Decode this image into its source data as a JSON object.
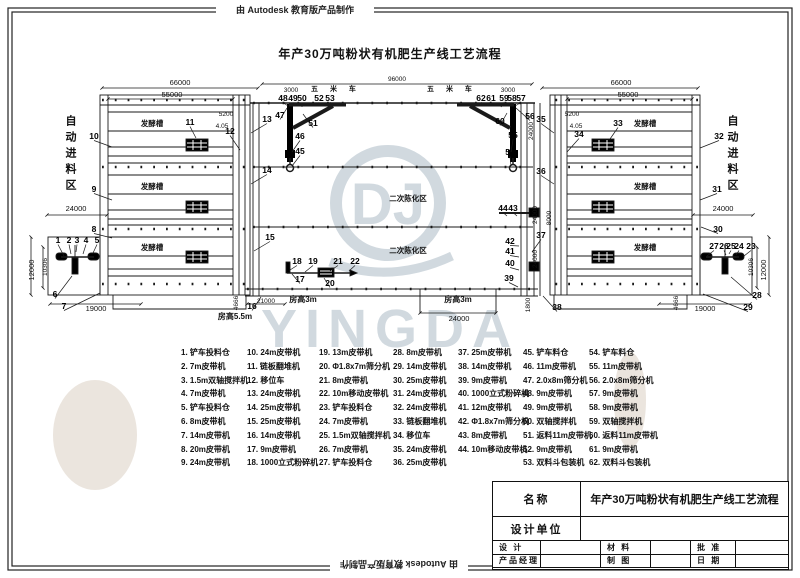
{
  "banner": {
    "top": "由 Autodesk 教育版产品制作",
    "bottom": "由 Autodesk 教育版产品制作"
  },
  "title": "年产30万吨粉状有机肥生产线工艺流程",
  "watermark": {
    "brand": "YINGDA",
    "monogram": "DJ"
  },
  "drawing": {
    "zone_left": "自动进料区",
    "zone_right": "自动进料区",
    "dims": [
      {
        "t": "66000",
        "x": 180,
        "y": 85
      },
      {
        "t": "55000",
        "x": 172,
        "y": 97
      },
      {
        "t": "96000",
        "x": 397,
        "y": 81,
        "c": "s"
      },
      {
        "t": "66000",
        "x": 621,
        "y": 85
      },
      {
        "t": "55000",
        "x": 628,
        "y": 97
      },
      {
        "t": "3000",
        "x": 291,
        "y": 92,
        "c": "s"
      },
      {
        "t": "3000",
        "x": 508,
        "y": 92,
        "c": "s"
      },
      {
        "t": "五 米 车",
        "x": 336,
        "y": 91,
        "c": "zs"
      },
      {
        "t": "五 米 车",
        "x": 452,
        "y": 91,
        "c": "zs"
      },
      {
        "t": "5200",
        "x": 226,
        "y": 116,
        "c": "s"
      },
      {
        "t": "4.05",
        "x": 222,
        "y": 128,
        "c": "s"
      },
      {
        "t": "5200",
        "x": 572,
        "y": 116,
        "c": "s"
      },
      {
        "t": "4.05",
        "x": 576,
        "y": 128,
        "c": "s"
      },
      {
        "t": "24000",
        "x": 76,
        "y": 211
      },
      {
        "t": "24000",
        "x": 723,
        "y": 211
      },
      {
        "t": "12000",
        "x": 34,
        "y": 270,
        "r": -90
      },
      {
        "t": "10306",
        "x": 47,
        "y": 267,
        "r": -90,
        "c": "s"
      },
      {
        "t": "10306",
        "x": 753,
        "y": 267,
        "r": -90,
        "c": "s"
      },
      {
        "t": "12000",
        "x": 766,
        "y": 270,
        "r": -90
      },
      {
        "t": "19000",
        "x": 96,
        "y": 311
      },
      {
        "t": "19000",
        "x": 705,
        "y": 311
      },
      {
        "t": "房高5.5m",
        "x": 235,
        "y": 319,
        "c": "b"
      },
      {
        "t": "4666",
        "x": 238,
        "y": 303,
        "r": -90,
        "c": "s"
      },
      {
        "t": "4666",
        "x": 678,
        "y": 303,
        "r": -90,
        "c": "s"
      },
      {
        "t": "21000",
        "x": 266,
        "y": 303,
        "c": "s"
      },
      {
        "t": "房高3m",
        "x": 303,
        "y": 302,
        "c": "b"
      },
      {
        "t": "房高3m",
        "x": 458,
        "y": 302,
        "c": "b"
      },
      {
        "t": "24000",
        "x": 459,
        "y": 321
      },
      {
        "t": "24000",
        "x": 533,
        "y": 131,
        "r": -90,
        "c": "s"
      },
      {
        "t": "24000",
        "x": 537,
        "y": 215,
        "r": -90,
        "c": "s"
      },
      {
        "t": "8000",
        "x": 551,
        "y": 218,
        "r": -90,
        "c": "s"
      },
      {
        "t": "24000",
        "x": 537,
        "y": 259,
        "r": -90,
        "c": "s"
      },
      {
        "t": "1800",
        "x": 530,
        "y": 305,
        "r": -90,
        "c": "s"
      },
      {
        "t": "发酵槽",
        "x": 152,
        "y": 126,
        "c": "bs"
      },
      {
        "t": "发酵槽",
        "x": 152,
        "y": 189,
        "c": "bs"
      },
      {
        "t": "发酵槽",
        "x": 152,
        "y": 250,
        "c": "bs"
      },
      {
        "t": "发酵槽",
        "x": 645,
        "y": 126,
        "c": "bs"
      },
      {
        "t": "发酵槽",
        "x": 645,
        "y": 189,
        "c": "bs"
      },
      {
        "t": "发酵槽",
        "x": 645,
        "y": 250,
        "c": "bs"
      },
      {
        "t": "二次陈化区",
        "x": 408,
        "y": 201,
        "c": "bs"
      },
      {
        "t": "二次陈化区",
        "x": 408,
        "y": 253,
        "c": "bs"
      }
    ],
    "parts": [
      {
        "n": "1",
        "x": 58,
        "y": 243,
        "lx": 64,
        "ly": 256
      },
      {
        "n": "2",
        "x": 69,
        "y": 243,
        "lx": 71,
        "ly": 254
      },
      {
        "n": "3",
        "x": 77,
        "y": 243,
        "lx": 76,
        "ly": 252
      },
      {
        "n": "4",
        "x": 86,
        "y": 243,
        "lx": 83,
        "ly": 254
      },
      {
        "n": "5",
        "x": 97,
        "y": 243,
        "lx": 93,
        "ly": 253
      },
      {
        "n": "6",
        "x": 55,
        "y": 297,
        "lx": 72,
        "ly": 276
      },
      {
        "n": "7",
        "x": 64,
        "y": 309,
        "lx": 100,
        "ly": 293
      },
      {
        "n": "8",
        "x": 94,
        "y": 232,
        "lx": 112,
        "ly": 238
      },
      {
        "n": "9",
        "x": 94,
        "y": 192,
        "lx": 112,
        "ly": 200
      },
      {
        "n": "10",
        "x": 94,
        "y": 139,
        "lx": 112,
        "ly": 147
      },
      {
        "n": "11",
        "x": 190,
        "y": 125,
        "lx": 196,
        "ly": 138
      },
      {
        "n": "12",
        "x": 230,
        "y": 134,
        "lx": 240,
        "ly": 150
      },
      {
        "n": "13",
        "x": 267,
        "y": 122,
        "lx": 251,
        "ly": 133
      },
      {
        "n": "14",
        "x": 267,
        "y": 173,
        "lx": 251,
        "ly": 184
      },
      {
        "n": "15",
        "x": 270,
        "y": 240,
        "lx": 254,
        "ly": 251
      },
      {
        "n": "16",
        "x": 252,
        "y": 309,
        "lx": 261,
        "ly": 297
      },
      {
        "n": "17",
        "x": 300,
        "y": 282,
        "lx": 292,
        "ly": 274
      },
      {
        "n": "18",
        "x": 297,
        "y": 264,
        "lx": 290,
        "ly": 270
      },
      {
        "n": "19",
        "x": 313,
        "y": 264,
        "lx": 305,
        "ly": 272
      },
      {
        "n": "20",
        "x": 330,
        "y": 286,
        "lx": 324,
        "ly": 278
      },
      {
        "n": "21",
        "x": 338,
        "y": 264,
        "lx": 330,
        "ly": 271
      },
      {
        "n": "22",
        "x": 355,
        "y": 264,
        "lx": 349,
        "ly": 271
      },
      {
        "n": "23",
        "x": 751,
        "y": 249,
        "lx": 744,
        "ly": 256
      },
      {
        "n": "24",
        "x": 739,
        "y": 249,
        "lx": 736,
        "ly": 255
      },
      {
        "n": "25",
        "x": 731,
        "y": 249,
        "lx": 729,
        "ly": 254
      },
      {
        "n": "26",
        "x": 724,
        "y": 249,
        "lx": 726,
        "ly": 255
      },
      {
        "n": "27",
        "x": 714,
        "y": 249,
        "lx": 707,
        "ly": 256
      },
      {
        "n": "28",
        "x": 757,
        "y": 298,
        "lx": 731,
        "ly": 277
      },
      {
        "n": "29",
        "x": 748,
        "y": 310,
        "lx": 703,
        "ly": 294
      },
      {
        "n": "30",
        "x": 718,
        "y": 232,
        "lx": 701,
        "ly": 227
      },
      {
        "n": "31",
        "x": 717,
        "y": 192,
        "lx": 700,
        "ly": 200
      },
      {
        "n": "32",
        "x": 719,
        "y": 139,
        "lx": 700,
        "ly": 148
      },
      {
        "n": "33",
        "x": 618,
        "y": 126,
        "lx": 610,
        "ly": 139
      },
      {
        "n": "34",
        "x": 579,
        "y": 137,
        "lx": 567,
        "ly": 152
      },
      {
        "n": "35",
        "x": 541,
        "y": 122,
        "lx": 554,
        "ly": 133
      },
      {
        "n": "36",
        "x": 541,
        "y": 174,
        "lx": 554,
        "ly": 184
      },
      {
        "n": "37",
        "x": 541,
        "y": 238,
        "lx": 532,
        "ly": 252
      },
      {
        "n": "38",
        "x": 557,
        "y": 310,
        "lx": 543,
        "ly": 296
      },
      {
        "n": "39",
        "x": 509,
        "y": 281,
        "lx": 518,
        "ly": 287
      },
      {
        "n": "40",
        "x": 510,
        "y": 266,
        "lx": 519,
        "ly": 270
      },
      {
        "n": "41",
        "x": 510,
        "y": 254,
        "lx": 519,
        "ly": 257
      },
      {
        "n": "42",
        "x": 510,
        "y": 244,
        "lx": 519,
        "ly": 246
      },
      {
        "n": "43",
        "x": 513,
        "y": 211,
        "lx": 517,
        "ly": 216
      },
      {
        "n": "44",
        "x": 503,
        "y": 211,
        "lx": 507,
        "ly": 216
      },
      {
        "n": "45",
        "x": 300,
        "y": 154,
        "lx": 292,
        "ly": 166
      },
      {
        "n": "46",
        "x": 300,
        "y": 139,
        "lx": 292,
        "ly": 152
      },
      {
        "n": "47",
        "x": 280,
        "y": 118,
        "lx": 287,
        "ly": 108
      },
      {
        "n": "48",
        "x": 283,
        "y": 101,
        "lx": 288,
        "ly": 106
      },
      {
        "n": "49",
        "x": 293,
        "y": 101,
        "lx": 295,
        "ly": 106
      },
      {
        "n": "50",
        "x": 302,
        "y": 101,
        "lx": 302,
        "ly": 107
      },
      {
        "n": "51",
        "x": 313,
        "y": 126,
        "lx": 303,
        "ly": 114
      },
      {
        "n": "52",
        "x": 319,
        "y": 101,
        "lx": 316,
        "ly": 106
      },
      {
        "n": "53",
        "x": 330,
        "y": 101,
        "lx": 336,
        "ly": 105
      },
      {
        "n": "54",
        "x": 510,
        "y": 155,
        "lx": 511,
        "ly": 166
      },
      {
        "n": "55",
        "x": 513,
        "y": 138,
        "lx": 511,
        "ly": 152
      },
      {
        "n": "56",
        "x": 530,
        "y": 119,
        "lx": 516,
        "ly": 108
      },
      {
        "n": "57",
        "x": 521,
        "y": 101,
        "lx": 515,
        "ly": 106
      },
      {
        "n": "58",
        "x": 512,
        "y": 101,
        "lx": 508,
        "ly": 106
      },
      {
        "n": "59",
        "x": 504,
        "y": 101,
        "lx": 501,
        "ly": 107
      },
      {
        "n": "60",
        "x": 500,
        "y": 124,
        "lx": 507,
        "ly": 113
      },
      {
        "n": "61",
        "x": 491,
        "y": 101,
        "lx": 495,
        "ly": 106
      },
      {
        "n": "62",
        "x": 481,
        "y": 101,
        "lx": 487,
        "ly": 105
      }
    ]
  },
  "legend": {
    "columns": [
      [
        "1. 铲车投料仓",
        "2. 7m皮带机",
        "3. 1.5m双轴搅拌机",
        "4. 7m皮带机",
        "5. 铲车投料仓",
        "6. 8m皮带机",
        "7. 14m皮带机",
        "8. 20m皮带机",
        "9. 24m皮带机"
      ],
      [
        "10. 24m皮带机",
        "11. 链板翻堆机",
        "12. 移位车",
        "13. 24m皮带机",
        "14. 25m皮带机",
        "15. 25m皮带机",
        "16. 14m皮带机",
        "17. 9m皮带机",
        "18. 1000立式粉碎机"
      ],
      [
        "19. 13m皮带机",
        "20. Φ1.8x7m筛分机",
        "21. 8m皮带机",
        "22. 10m移动皮带机",
        "23. 铲车投料仓",
        "24. 7m皮带机",
        "25. 1.5m双轴搅拌机",
        "26. 7m皮带机",
        "27. 铲车投料仓"
      ],
      [
        "28. 8m皮带机",
        "29. 14m皮带机",
        "30. 25m皮带机",
        "31. 24m皮带机",
        "32. 24m皮带机",
        "33. 链板翻堆机",
        "34. 移位车",
        "35. 24m皮带机",
        "36. 25m皮带机"
      ],
      [
        "37. 25m皮带机",
        "38. 14m皮带机",
        "39. 9m皮带机",
        "40. 1000立式粉碎机",
        "41. 12m皮带机",
        "42. Φ1.8x7m筛分机",
        "43. 8m皮带机",
        "44. 10m移动皮带机"
      ],
      [
        "45. 铲车料仓",
        "46. 11m皮带机",
        "47. 2.0x8m筛分机",
        "48. 9m皮带机",
        "49. 9m皮带机",
        "50. 双轴搅拌机",
        "51. 返料11m皮带机",
        "52. 9m皮带机",
        "53. 双料斗包装机"
      ],
      [
        "54. 铲车料仓",
        "55. 11m皮带机",
        "56. 2.0x8m筛分机",
        "57. 9m皮带机",
        "58. 9m皮带机",
        "59. 双轴搅拌机",
        "60. 返料11m皮带机",
        "61. 9m皮带机",
        "62. 双料斗包装机"
      ]
    ]
  },
  "titleblock": {
    "name_label": "名称",
    "name_value": "年产30万吨粉状有机肥生产线工艺流程",
    "design_unit_label": "设计单位",
    "design_label": "设 计",
    "pm_label": "产品经理",
    "material_label": "材 料",
    "draft_label": "制 图",
    "approve_label": "批 准",
    "date_label": "日 期"
  }
}
